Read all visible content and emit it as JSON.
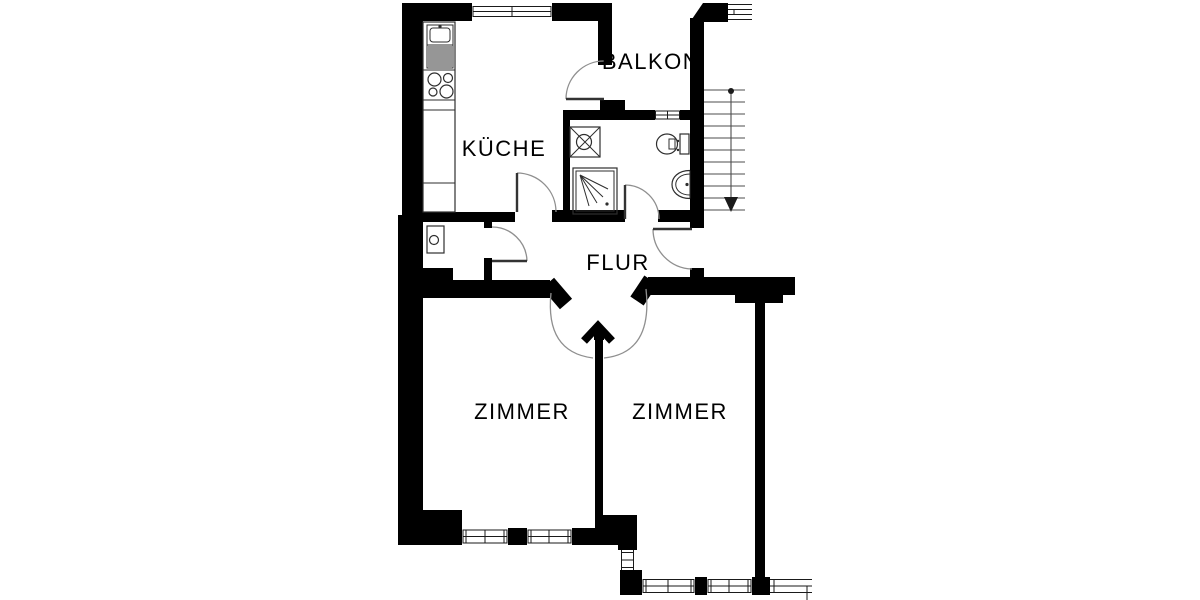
{
  "labels": {
    "kitchen": "KÜCHE",
    "balcony": "BALKON",
    "hallway": "FLUR",
    "room_left": "ZIMMER",
    "room_right": "ZIMMER"
  },
  "colors": {
    "background": "#ffffff",
    "wall": "#000000",
    "fixture_line": "#2e2e2e",
    "door_arc": "#8f8f8f",
    "stair_line": "#4d4d4d",
    "text": "#000000"
  },
  "fixtures": [
    {
      "name": "kitchen-sink-unit-icon"
    },
    {
      "name": "stove-icon"
    },
    {
      "name": "kitchen-counter"
    },
    {
      "name": "boiler-icon"
    },
    {
      "name": "washing-machine-icon"
    },
    {
      "name": "shower-icon"
    },
    {
      "name": "toilet-icon"
    },
    {
      "name": "washbasin-icon"
    },
    {
      "name": "stairs-icon"
    },
    {
      "name": "stair-direction-arrow-icon"
    }
  ],
  "windows_count": 8,
  "doors_count": 7
}
